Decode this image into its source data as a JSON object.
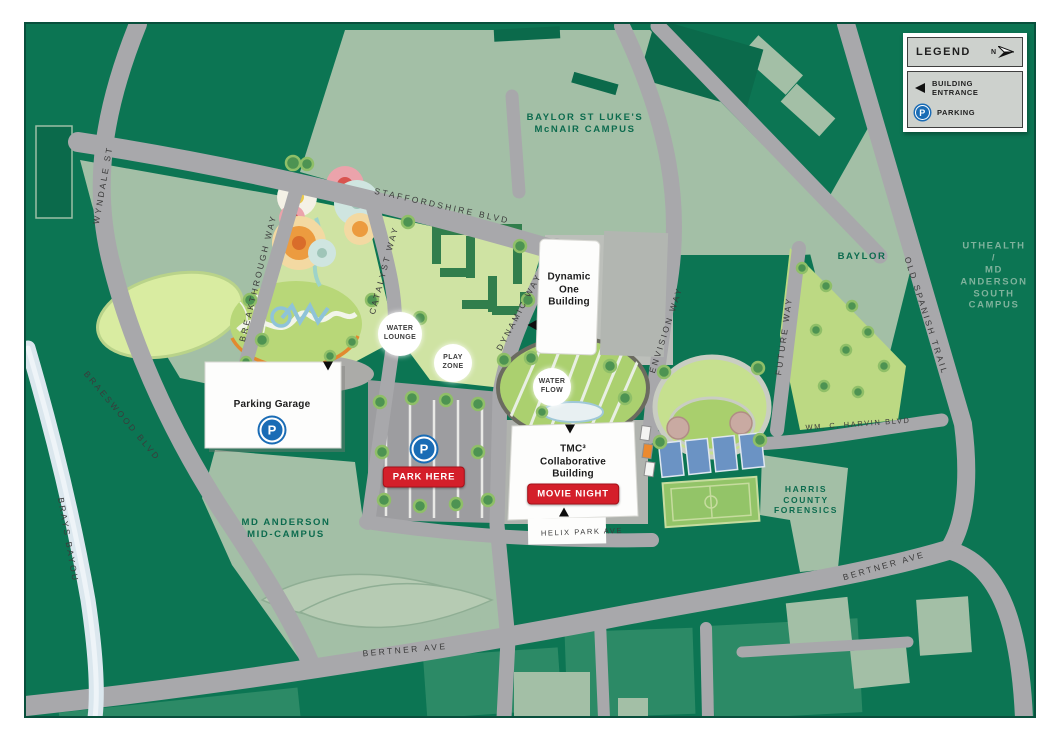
{
  "legend": {
    "title": "LEGEND",
    "north_label": "N",
    "items": [
      {
        "icon": "building-entrance-arrow",
        "label": "BUILDING ENTRANCE"
      },
      {
        "icon": "parking-p",
        "label": "PARKING"
      }
    ]
  },
  "streets": {
    "staffordshire": "STAFFORDSHIRE BLVD",
    "wyndale": "WYNDALE ST",
    "braeswood": "BRAESWOOD BLVD",
    "brays_bayou": "BRAYS BAYOU",
    "breakthrough": "BREAKTHROUGH WAY",
    "catalyst": "CATALYST WAY",
    "dynamic": "DYNAMIC WAY",
    "envision": "ENVISION WAY",
    "future": "FUTURE WAY",
    "old_spanish_trail": "OLD SPANISH TRAIL",
    "wm_c_harvin": "WM. C. HARVIN BLVD",
    "helix_park": "HELIX PARK AVE",
    "bertner_west": "BERTNER AVE",
    "bertner_east": "BERTNER AVE"
  },
  "campuses": {
    "mcnair": "BAYLOR ST LUKE'S\nMcNAIR CAMPUS",
    "uthealth": "UTHEALTH /\nMD ANDERSON\nSOUTH CAMPUS",
    "baylor": "BAYLOR",
    "harris_forensics": "HARRIS\nCOUNTY\nFORENSICS",
    "md_anderson_mid": "MD ANDERSON\nMID-CAMPUS"
  },
  "buildings": {
    "dynamic_one": "Dynamic\nOne\nBuilding",
    "parking_garage": "Parking Garage",
    "tmc3": "TMC³\nCollaborative\nBuilding"
  },
  "badges": {
    "park_here": "PARK HERE",
    "movie_night": "MOVIE NIGHT"
  },
  "icons": {
    "parking_p": "P"
  },
  "park_features": {
    "water_lounge": "WATER\nLOUNGE",
    "play_zone": "PLAY\nZONE",
    "water_flow": "WATER\nFLOW"
  },
  "colors": {
    "map_green": "#0C7553",
    "campus_sage": "#A3BFA6",
    "road_gray": "#A8A8AB",
    "park_green": "#CFE3A3",
    "accent_red": "#D41F2A",
    "parking_blue": "#1A6CB5",
    "bayou_blue": "#DBE7EE"
  }
}
